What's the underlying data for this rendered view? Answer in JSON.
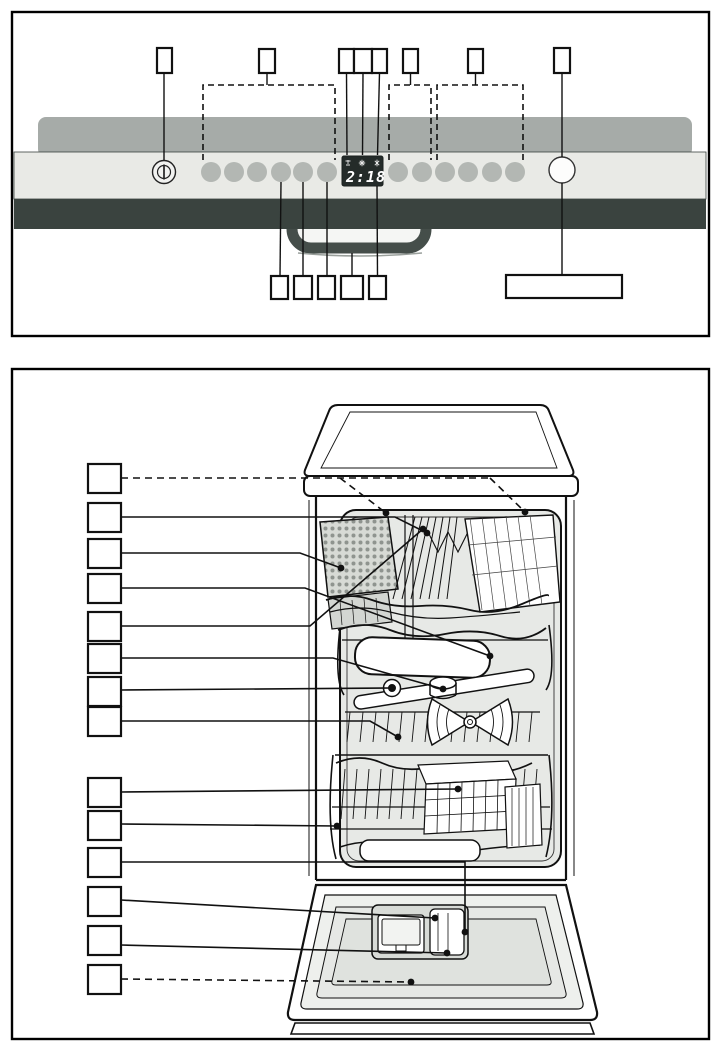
{
  "display": {
    "value": "2:18",
    "indicator_icons": [
      "water-supply-icon",
      "rinse-aid-icon",
      "salt-icon"
    ]
  },
  "control_panel_figure": {
    "power_button_icon": "power-icon",
    "button_count_left": 6,
    "button_count_right": 6,
    "start_button_count": 1,
    "callout_boxes_top": [
      "",
      "",
      "",
      "",
      "",
      "",
      ""
    ],
    "callout_boxes_bottom": [
      "",
      "",
      "",
      "",
      "",
      ""
    ],
    "dashed_group_count": 3
  },
  "interior_figure": {
    "callout_boxes": [
      "",
      "",
      "",
      "",
      "",
      "",
      "",
      "",
      "",
      "",
      "",
      "",
      "",
      ""
    ],
    "dashed_leader_indices": [
      1,
      14
    ]
  },
  "colors": {
    "frame": "#000000",
    "fascia": "#e9eae6",
    "top_edge": "#a6aba8",
    "front_band": "#3a433f",
    "display_bg": "#242b29",
    "display_text": "#ffffff",
    "button": "#b3b7b3",
    "line_art": "#111111",
    "tub_interior": "#e7e9e6"
  }
}
